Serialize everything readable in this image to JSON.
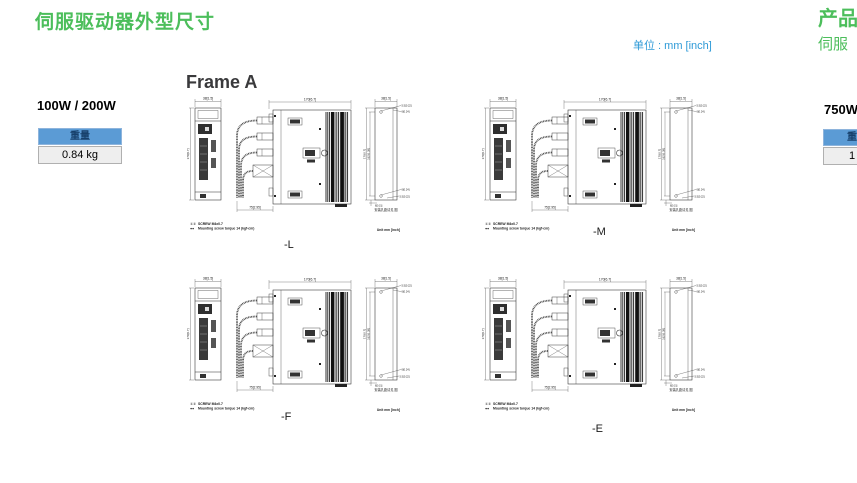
{
  "page": {
    "title": "伺服驱动器外型尺寸",
    "unit_note": "单位 : mm [inch]"
  },
  "right_page_edge": {
    "title_fragment": "产品",
    "subtitle_fragment": "伺服",
    "power_label": "750W",
    "weight_table": {
      "header_fragment": "重",
      "value_fragment": "1"
    }
  },
  "frame_a": {
    "heading": "Frame A",
    "power_label": "100W / 200W",
    "weight_table": {
      "header": "重量",
      "value": "0.84 kg"
    },
    "drawings": [
      {
        "label": "-L"
      },
      {
        "label": "-M"
      },
      {
        "label": "-F"
      },
      {
        "label": "-E"
      }
    ],
    "drawing_common": {
      "dim_width_top": "38[1.5]",
      "dim_height_left": "170[6.7]",
      "dim_depth_top": "170[6.7]",
      "dim_cable_bottom": "75[2.95]",
      "rear_dim_width_top": "38[1.5]",
      "rear_dim_hole_top1": "5.5[0.22]",
      "rear_dim_hole_top2": "6[0.24]",
      "rear_dim_height": "170[6.7]",
      "rear_dim_mount": "162[6.38]",
      "rear_dim_hole_bot1": "6[0.24]",
      "rear_dim_hole_bot2": "5.5[0.22]",
      "rear_dim_bottom_offset": "8[0.31]",
      "rear_note": "安装孔距请见 图",
      "screw_note_prefix": "①②",
      "screw_note_line1": "SCREW M4x0.7",
      "screw_bullet_prefix": "●●",
      "screw_note_line2": "Mounting screw torque 14 (kgf-cm)",
      "unit_note": "Unit mm [inch]"
    }
  },
  "colors": {
    "accent_green": "#4cbe5b",
    "accent_blue": "#2e9ad7",
    "table_header_bg": "#5b9bd5",
    "table_header_text": "#17406b",
    "table_value_bg": "#eeeeee"
  }
}
